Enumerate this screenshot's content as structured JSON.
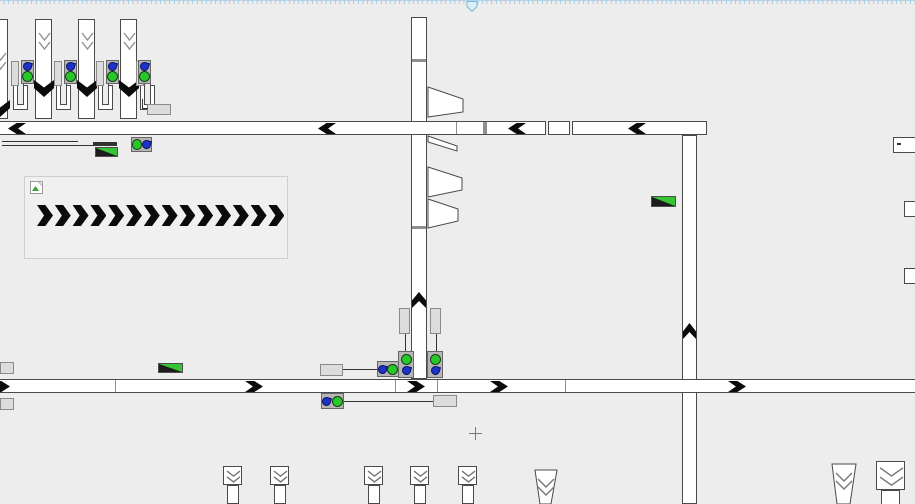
{
  "window": {
    "ruler": {
      "orientation": "horizontal",
      "height": 13,
      "marker_x": 466
    },
    "cursor": {
      "type": "crosshair",
      "x": 475,
      "y": 433
    }
  },
  "colors": {
    "canvas_bg": "#ededed",
    "conveyor_fill": "#ffffff",
    "conveyor_border": "#4a4a4a",
    "segment_divider": "#8f8f8f",
    "chevron": "#0b0b0b",
    "slot_fill": "#dcdcdc",
    "sensor_box": "#b6b6b6",
    "status_green": "#29c829",
    "flow_blue": "#1e32c8",
    "wedge_green": "#35c435",
    "outline_chevron": "#909090",
    "ruler_tick": "#a9cfe3",
    "ruler_marker_stroke": "#79b7d7",
    "ruler_marker_fill": "#dceef8"
  },
  "canvas": {
    "conveyors_vertical": [
      {
        "id": "vertical-center",
        "x": 411,
        "y": 17,
        "w": 16,
        "h": 362
      },
      {
        "id": "vertical-right",
        "x": 682,
        "y": 135,
        "w": 15,
        "h": 369
      }
    ],
    "conveyors_horizontal": [
      {
        "id": "top-main-1",
        "x": -2,
        "y": 121,
        "w": 548,
        "h": 14
      },
      {
        "id": "top-main-2",
        "x": 548,
        "y": 121,
        "w": 22,
        "h": 14
      },
      {
        "id": "top-main-3",
        "x": 572,
        "y": 121,
        "w": 135,
        "h": 14
      },
      {
        "id": "bottom-main",
        "x": -2,
        "y": 379,
        "w": 919,
        "h": 14
      }
    ],
    "dividers": [
      {
        "x": 412,
        "y": 59,
        "w": 14,
        "h": 3
      },
      {
        "x": 412,
        "y": 226,
        "w": 14,
        "h": 3
      },
      {
        "x": 456,
        "y": 122,
        "w": 1,
        "h": 12
      },
      {
        "x": 483,
        "y": 122,
        "w": 4,
        "h": 12
      },
      {
        "x": 115,
        "y": 380,
        "w": 1,
        "h": 12
      },
      {
        "x": 395,
        "y": 380,
        "w": 1,
        "h": 12
      },
      {
        "x": 437,
        "y": 380,
        "w": 1,
        "h": 12
      },
      {
        "x": 565,
        "y": 380,
        "w": 1,
        "h": 12
      }
    ],
    "chevrons": [
      {
        "dir": "left",
        "x": 8,
        "y": 123,
        "w": 18,
        "h": 11
      },
      {
        "dir": "left",
        "x": 318,
        "y": 123,
        "w": 18,
        "h": 11
      },
      {
        "dir": "left",
        "x": 508,
        "y": 123,
        "w": 18,
        "h": 11
      },
      {
        "dir": "left",
        "x": 628,
        "y": 123,
        "w": 18,
        "h": 11
      },
      {
        "dir": "right",
        "x": -8,
        "y": 381,
        "w": 18,
        "h": 11
      },
      {
        "dir": "right",
        "x": 245,
        "y": 381,
        "w": 18,
        "h": 11
      },
      {
        "dir": "right",
        "x": 407,
        "y": 381,
        "w": 18,
        "h": 11
      },
      {
        "dir": "right",
        "x": 490,
        "y": 381,
        "w": 18,
        "h": 11
      },
      {
        "dir": "right",
        "x": 728,
        "y": 381,
        "w": 18,
        "h": 11
      },
      {
        "dir": "up",
        "x": 412,
        "y": 292,
        "w": 14,
        "h": 16
      },
      {
        "dir": "up",
        "x": 683,
        "y": 323,
        "w": 13,
        "h": 16
      }
    ],
    "gates_top": {
      "y": 19,
      "w": 17,
      "h": 100,
      "items": [
        {
          "x": -9,
          "glyph_dy": 20
        },
        {
          "x": 35,
          "glyph_dy": 0
        },
        {
          "x": 78,
          "glyph_dy": 0
        },
        {
          "x": 120,
          "glyph_dy": 0
        }
      ]
    },
    "hooks": {
      "y": 85,
      "w": 15,
      "h": 25,
      "xs": [
        13,
        56,
        98,
        140
      ]
    },
    "slots": [
      {
        "x": 11,
        "y": 61,
        "w": 8,
        "h": 25
      },
      {
        "x": 54,
        "y": 61,
        "w": 8,
        "h": 25
      },
      {
        "x": 96,
        "y": 61,
        "w": 8,
        "h": 25
      },
      {
        "x": 136,
        "y": 61,
        "w": 8,
        "h": 25
      },
      {
        "x": 399,
        "y": 308,
        "w": 11,
        "h": 26
      },
      {
        "x": 430,
        "y": 308,
        "w": 11,
        "h": 26
      }
    ],
    "sensors": [
      {
        "x": 21,
        "y": 60,
        "w": 13,
        "h": 24,
        "layout": "v",
        "order": [
          "drop",
          "dot"
        ]
      },
      {
        "x": 64,
        "y": 60,
        "w": 13,
        "h": 24,
        "layout": "v",
        "order": [
          "drop",
          "dot"
        ]
      },
      {
        "x": 106,
        "y": 60,
        "w": 13,
        "h": 24,
        "layout": "v",
        "order": [
          "drop",
          "dot"
        ]
      },
      {
        "x": 138,
        "y": 60,
        "w": 13,
        "h": 24,
        "layout": "v",
        "order": [
          "drop",
          "dot"
        ]
      },
      {
        "x": 131,
        "y": 137,
        "w": 21,
        "h": 15,
        "layout": "h",
        "order": [
          "dot",
          "drop"
        ]
      },
      {
        "x": 377,
        "y": 361,
        "w": 22,
        "h": 16,
        "layout": "h",
        "order": [
          "drop",
          "dot"
        ]
      },
      {
        "x": 321,
        "y": 393,
        "w": 23,
        "h": 16,
        "layout": "h",
        "order": [
          "drop",
          "dot"
        ]
      },
      {
        "x": 398,
        "y": 351,
        "w": 16,
        "h": 27,
        "layout": "v",
        "order": [
          "dot",
          "drop"
        ]
      },
      {
        "x": 427,
        "y": 351,
        "w": 16,
        "h": 27,
        "layout": "v",
        "order": [
          "dot",
          "drop"
        ]
      }
    ],
    "labels": [
      {
        "x": 147,
        "y": 104,
        "w": 24,
        "h": 11
      },
      {
        "x": 320,
        "y": 364,
        "w": 23,
        "h": 12
      },
      {
        "x": 433,
        "y": 395,
        "w": 24,
        "h": 12
      },
      {
        "x": 0,
        "y": 362,
        "w": 14,
        "h": 12
      },
      {
        "x": 0,
        "y": 398,
        "w": 14,
        "h": 12
      }
    ],
    "lines": [
      {
        "x": 2,
        "y": 141,
        "w": 76,
        "h": 1
      },
      {
        "x": 2,
        "y": 145,
        "w": 91,
        "h": 1
      },
      {
        "x": 142,
        "y": 99,
        "w": 1,
        "h": 10
      },
      {
        "x": 142,
        "y": 108,
        "w": 6,
        "h": 1
      },
      {
        "x": 405,
        "y": 334,
        "w": 1,
        "h": 18
      },
      {
        "x": 436,
        "y": 334,
        "w": 1,
        "h": 18
      },
      {
        "x": 343,
        "y": 369,
        "w": 34,
        "h": 1
      },
      {
        "x": 344,
        "y": 401,
        "w": 89,
        "h": 1
      },
      {
        "x": 93,
        "y": 142,
        "w": 24,
        "h": 4
      }
    ],
    "wedges": [
      {
        "x": 95,
        "y": 147,
        "w": 23,
        "h": 10
      },
      {
        "x": 158,
        "y": 363,
        "w": 25,
        "h": 10
      },
      {
        "x": 651,
        "y": 196,
        "w": 25,
        "h": 11
      }
    ],
    "diverters": [
      {
        "pts": [
          [
            428,
            87
          ],
          [
            463,
            99
          ],
          [
            463,
            112
          ],
          [
            428,
            117
          ]
        ]
      },
      {
        "pts": [
          [
            428,
            136
          ],
          [
            457,
            146
          ],
          [
            457,
            151
          ],
          [
            428,
            142
          ]
        ]
      },
      {
        "pts": [
          [
            428,
            167
          ],
          [
            462,
            178
          ],
          [
            462,
            190
          ],
          [
            428,
            197
          ]
        ]
      },
      {
        "pts": [
          [
            428,
            199
          ],
          [
            458,
            209
          ],
          [
            458,
            221
          ],
          [
            428,
            228
          ]
        ]
      }
    ],
    "legend_panel": {
      "x": 24,
      "y": 176,
      "w": 264,
      "h": 83,
      "broken_image_icon": {
        "x": 5,
        "y": 4,
        "w": 13,
        "h": 13
      },
      "chevrons": {
        "count": 14,
        "x": 12,
        "y": 28,
        "step": 17.8,
        "w": 16,
        "h": 21,
        "direction": "right"
      }
    },
    "gates_bottom": [
      {
        "type": "head",
        "x": 223,
        "y": 466,
        "head": 19,
        "bw": 12,
        "bh": 19
      },
      {
        "type": "head",
        "x": 270,
        "y": 466,
        "head": 19,
        "bw": 12,
        "bh": 19
      },
      {
        "type": "head",
        "x": 364,
        "y": 466,
        "head": 19,
        "bw": 12,
        "bh": 19
      },
      {
        "type": "head",
        "x": 410,
        "y": 466,
        "head": 19,
        "bw": 12,
        "bh": 19
      },
      {
        "type": "head",
        "x": 458,
        "y": 466,
        "head": 19,
        "bw": 12,
        "bh": 19
      },
      {
        "type": "head",
        "x": 876,
        "y": 461,
        "head": 29,
        "bw": 19,
        "bh": 15
      },
      {
        "type": "trap",
        "pts": [
          [
            535,
            470
          ],
          [
            557,
            470
          ],
          [
            551,
            504
          ],
          [
            540,
            504
          ]
        ]
      },
      {
        "type": "trap",
        "pts": [
          [
            832,
            464
          ],
          [
            856,
            464
          ],
          [
            850,
            504
          ],
          [
            837,
            504
          ]
        ]
      }
    ],
    "edge_boxes": [
      {
        "x": 893,
        "y": 137,
        "w": 23,
        "h": 16,
        "mark": true
      },
      {
        "x": 904,
        "y": 201,
        "w": 13,
        "h": 16,
        "mark": false
      },
      {
        "x": 904,
        "y": 268,
        "w": 13,
        "h": 16,
        "mark": false
      }
    ]
  }
}
